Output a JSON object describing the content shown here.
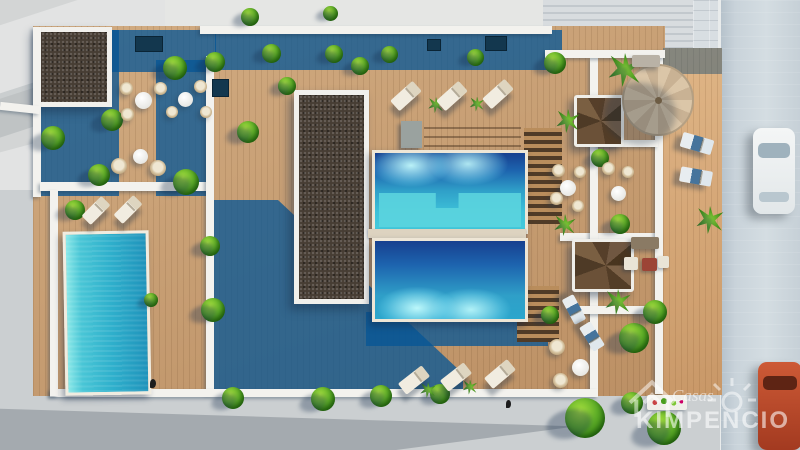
{
  "scene": {
    "title": "Aerial 3D architectural render of residential complex with rooftop pools and terraces",
    "palette": {
      "pavement": "#d3d5d5",
      "street": "#c9d3da",
      "deck_wood": "#c59a6e",
      "deck_shadow_teal": "#2e6b90",
      "pool_deep_blue": "#17408f",
      "pool_turquoise": "#35b4d2",
      "pool_shelf": "#5bd4de",
      "gravel_roof": "#473d34",
      "wall_white": "#f3f2ee",
      "foliage_green": "#5fae27",
      "umbrella_beige": "#d3bd9f",
      "car_white": "#eef1f2",
      "car_orange": "#b84a2e"
    },
    "features": [
      "two communal pools",
      "private pool",
      "wooden sun decks",
      "gravel roof sections",
      "spiral staircases",
      "large parasol",
      "sun loungers",
      "wicker chairs",
      "round tables",
      "hedges and palms",
      "street with parked cars"
    ]
  },
  "watermark": {
    "line1": "Casas",
    "line2": "KIMPENCIO",
    "icons": [
      "house-outline-icon",
      "sun-icon"
    ]
  },
  "objects": {
    "bush": {
      "css": "bush",
      "items": [
        {
          "x": 250,
          "y": 17,
          "d": 18
        },
        {
          "x": 330,
          "y": 13,
          "d": 15
        },
        {
          "x": 271,
          "y": 53,
          "d": 19
        },
        {
          "x": 334,
          "y": 54,
          "d": 18
        },
        {
          "x": 389,
          "y": 54,
          "d": 17
        },
        {
          "x": 475,
          "y": 57,
          "d": 17
        },
        {
          "x": 555,
          "y": 63,
          "d": 22
        },
        {
          "x": 215,
          "y": 62,
          "d": 20
        },
        {
          "x": 175,
          "y": 68,
          "d": 24
        },
        {
          "x": 287,
          "y": 86,
          "d": 18
        },
        {
          "x": 360,
          "y": 66,
          "d": 18
        },
        {
          "x": 112,
          "y": 120,
          "d": 22
        },
        {
          "x": 53,
          "y": 138,
          "d": 24
        },
        {
          "x": 248,
          "y": 132,
          "d": 22
        },
        {
          "x": 186,
          "y": 182,
          "d": 26
        },
        {
          "x": 99,
          "y": 175,
          "d": 22
        },
        {
          "x": 75,
          "y": 210,
          "d": 20
        },
        {
          "x": 210,
          "y": 246,
          "d": 20
        },
        {
          "x": 213,
          "y": 310,
          "d": 24
        },
        {
          "x": 233,
          "y": 398,
          "d": 22
        },
        {
          "x": 323,
          "y": 399,
          "d": 24
        },
        {
          "x": 381,
          "y": 396,
          "d": 22
        },
        {
          "x": 440,
          "y": 394,
          "d": 20
        },
        {
          "x": 600,
          "y": 158,
          "d": 18
        },
        {
          "x": 620,
          "y": 224,
          "d": 20
        },
        {
          "x": 550,
          "y": 315,
          "d": 18
        },
        {
          "x": 151,
          "y": 300,
          "d": 14
        },
        {
          "x": 634,
          "y": 338,
          "d": 30
        },
        {
          "x": 655,
          "y": 312,
          "d": 24
        },
        {
          "x": 585,
          "y": 418,
          "d": 40
        },
        {
          "x": 632,
          "y": 403,
          "d": 22
        },
        {
          "x": 664,
          "y": 428,
          "d": 34
        }
      ]
    },
    "palm": {
      "css": "palm",
      "items": [
        {
          "x": 625,
          "y": 70,
          "d": 34
        },
        {
          "x": 568,
          "y": 121,
          "d": 24
        },
        {
          "x": 710,
          "y": 220,
          "d": 28
        },
        {
          "x": 436,
          "y": 105,
          "d": 16
        },
        {
          "x": 477,
          "y": 104,
          "d": 15
        },
        {
          "x": 428,
          "y": 390,
          "d": 16
        },
        {
          "x": 470,
          "y": 387,
          "d": 15
        },
        {
          "x": 618,
          "y": 302,
          "d": 26
        },
        {
          "x": 565,
          "y": 225,
          "d": 22
        }
      ]
    },
    "lounger": {
      "css": "lounger",
      "items": [
        {
          "x": 406,
          "y": 96,
          "w": 30,
          "h": 14,
          "r": -42
        },
        {
          "x": 452,
          "y": 96,
          "w": 30,
          "h": 14,
          "r": -42
        },
        {
          "x": 498,
          "y": 94,
          "w": 30,
          "h": 14,
          "r": -42
        },
        {
          "x": 96,
          "y": 210,
          "w": 28,
          "h": 13,
          "r": -45
        },
        {
          "x": 128,
          "y": 209,
          "w": 28,
          "h": 13,
          "r": -45
        },
        {
          "x": 414,
          "y": 380,
          "w": 30,
          "h": 14,
          "r": -38
        },
        {
          "x": 456,
          "y": 377,
          "w": 30,
          "h": 14,
          "r": -38
        },
        {
          "x": 500,
          "y": 374,
          "w": 30,
          "h": 14,
          "r": -40
        },
        {
          "x": 697,
          "y": 143,
          "w": 32,
          "h": 15,
          "r": 16,
          "v": "blue"
        },
        {
          "x": 696,
          "y": 176,
          "w": 32,
          "h": 15,
          "r": 10,
          "v": "blue"
        },
        {
          "x": 574,
          "y": 309,
          "w": 28,
          "h": 13,
          "r": 62,
          "v": "blue"
        },
        {
          "x": 592,
          "y": 336,
          "w": 28,
          "h": 13,
          "r": 58,
          "v": "blue"
        }
      ]
    },
    "table": {
      "css": "wtable",
      "items": [
        {
          "x": 143,
          "y": 100,
          "d": 17
        },
        {
          "x": 185,
          "y": 99,
          "d": 15
        },
        {
          "x": 140,
          "y": 156,
          "d": 15
        },
        {
          "x": 568,
          "y": 188,
          "d": 16
        },
        {
          "x": 618,
          "y": 193,
          "d": 15
        },
        {
          "x": 580,
          "y": 367,
          "d": 17
        }
      ]
    },
    "chair": {
      "css": "wchair",
      "items": [
        {
          "x": 126,
          "y": 88,
          "d": 13
        },
        {
          "x": 160,
          "y": 88,
          "d": 13
        },
        {
          "x": 127,
          "y": 114,
          "d": 13
        },
        {
          "x": 200,
          "y": 86,
          "d": 13
        },
        {
          "x": 172,
          "y": 112,
          "d": 12
        },
        {
          "x": 206,
          "y": 112,
          "d": 12
        },
        {
          "x": 119,
          "y": 166,
          "d": 16
        },
        {
          "x": 158,
          "y": 168,
          "d": 16
        },
        {
          "x": 558,
          "y": 170,
          "d": 13
        },
        {
          "x": 580,
          "y": 172,
          "d": 12
        },
        {
          "x": 556,
          "y": 198,
          "d": 13
        },
        {
          "x": 578,
          "y": 206,
          "d": 12
        },
        {
          "x": 608,
          "y": 168,
          "d": 13
        },
        {
          "x": 628,
          "y": 172,
          "d": 12
        },
        {
          "x": 557,
          "y": 347,
          "d": 16
        },
        {
          "x": 560,
          "y": 380,
          "d": 15
        }
      ]
    },
    "sofa": {
      "css": "sofa",
      "items": [
        {
          "x": 646,
          "y": 61,
          "w": 28,
          "h": 12
        },
        {
          "x": 645,
          "y": 243,
          "w": 28,
          "h": 12,
          "v": "brown"
        }
      ]
    },
    "ottoman": {
      "css": "ottoman",
      "items": [
        {
          "x": 631,
          "y": 263,
          "w": 14,
          "h": 13
        },
        {
          "x": 663,
          "y": 262,
          "w": 11,
          "h": 12
        },
        {
          "x": 649,
          "y": 264,
          "w": 15,
          "h": 13,
          "v": "red"
        }
      ]
    },
    "vent": {
      "css": "vent",
      "items": [
        {
          "x": 148,
          "y": 43,
          "w": 26,
          "h": 14
        },
        {
          "x": 219,
          "y": 87,
          "w": 15,
          "h": 16
        },
        {
          "x": 495,
          "y": 42,
          "w": 20,
          "h": 13
        },
        {
          "x": 433,
          "y": 44,
          "w": 12,
          "h": 10
        }
      ]
    },
    "bird": {
      "css": "bird",
      "items": [
        {
          "x": 508,
          "y": 404,
          "w": 5,
          "h": 8
        },
        {
          "x": 153,
          "y": 383,
          "w": 6,
          "h": 9
        }
      ]
    },
    "planter": {
      "css": "planter",
      "items": [
        {
          "x": 667,
          "y": 402,
          "w": 40,
          "h": 15
        }
      ]
    }
  }
}
